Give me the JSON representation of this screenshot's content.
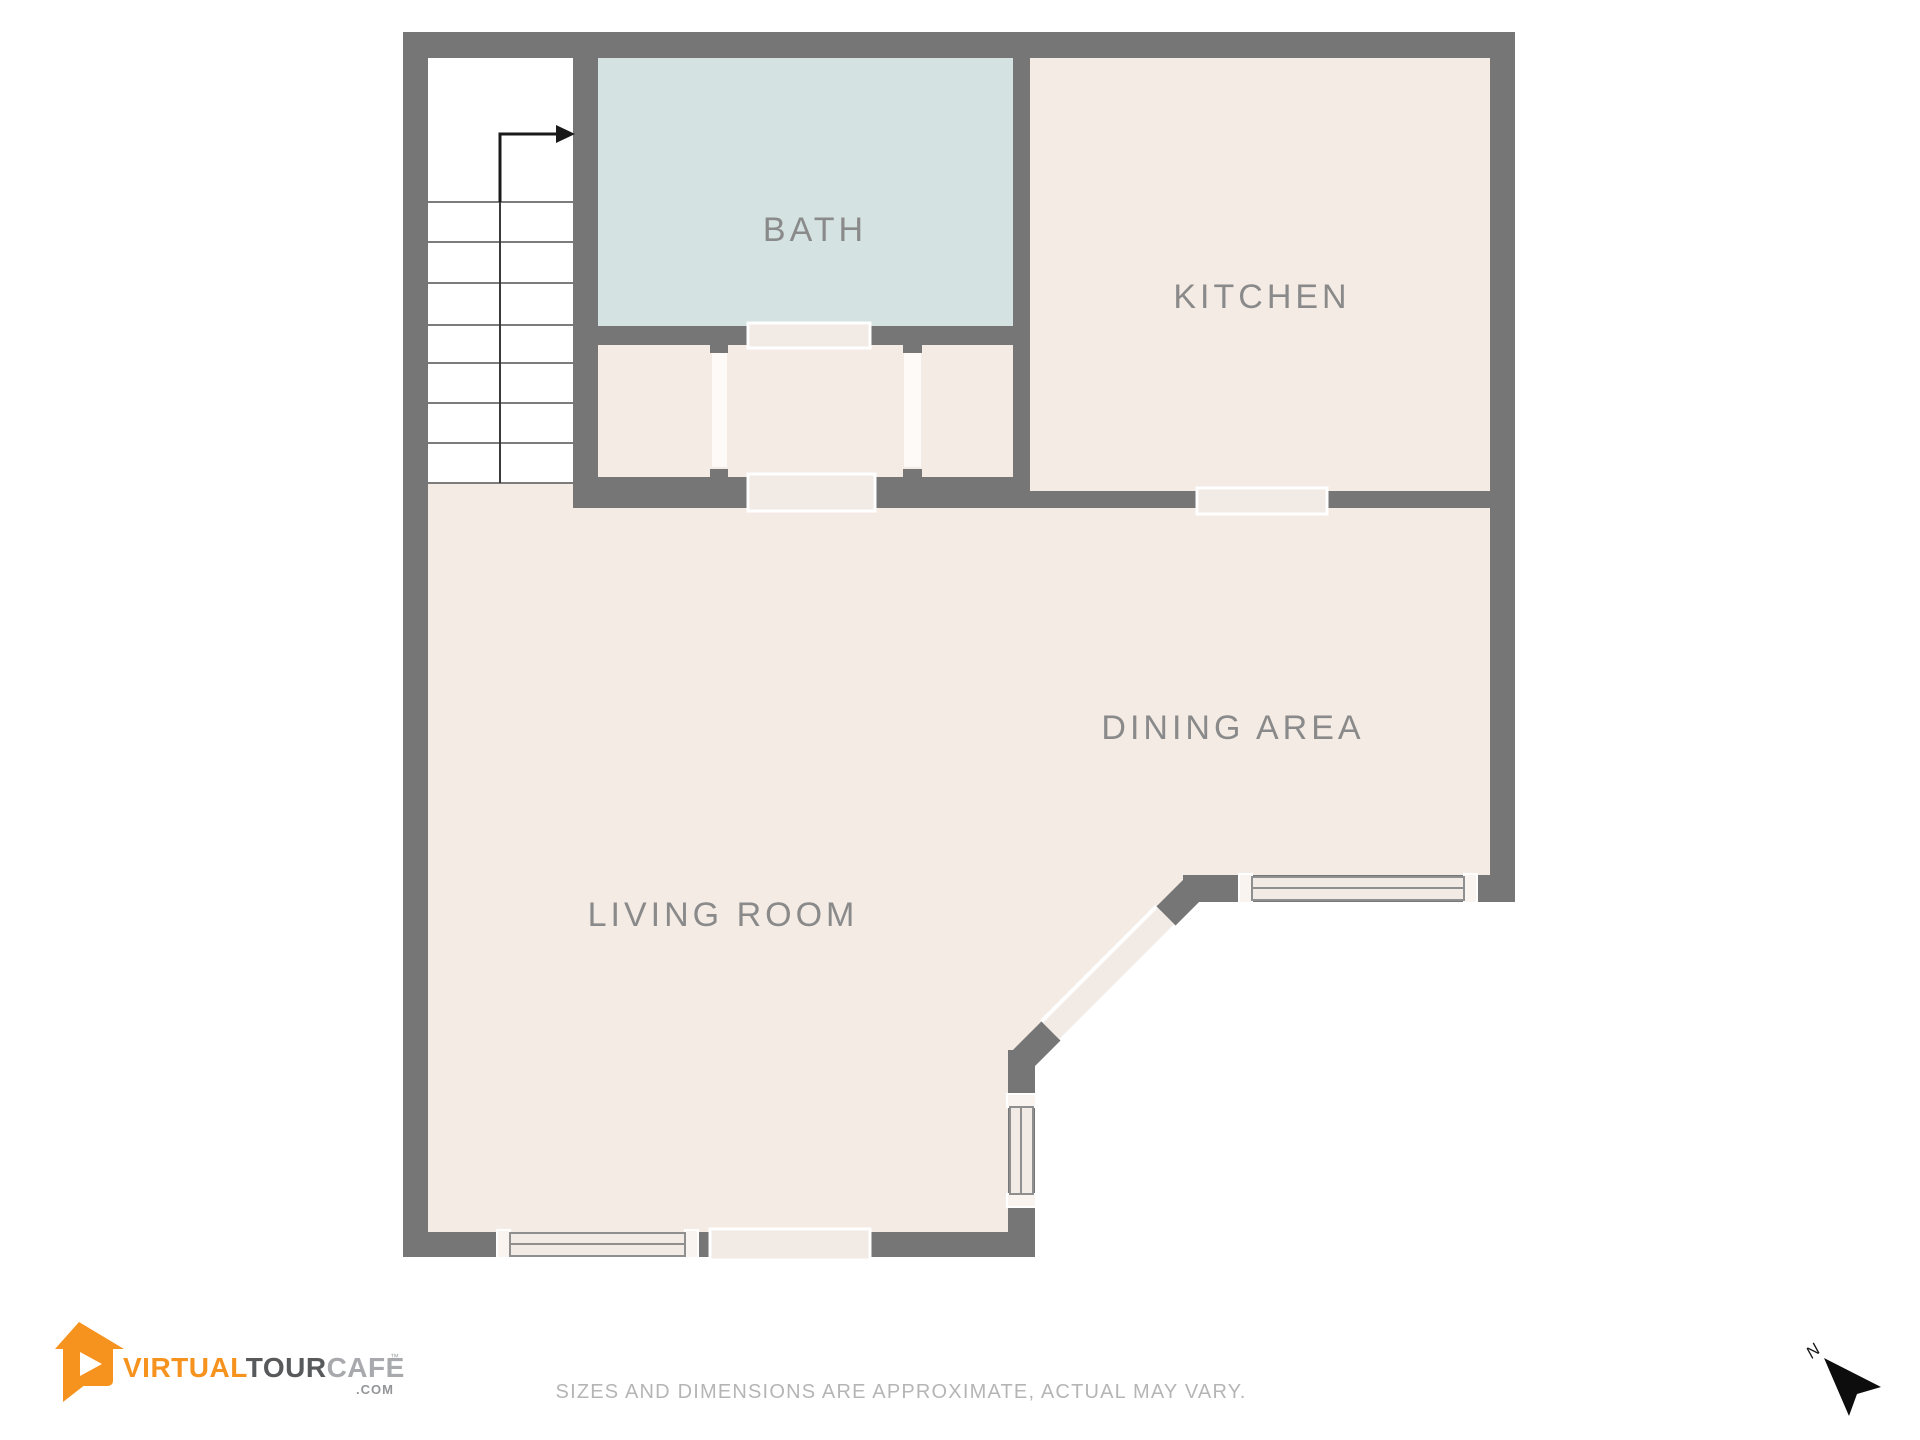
{
  "plan": {
    "rooms": {
      "bath": {
        "label": "BATH"
      },
      "kitchen": {
        "label": "KITCHEN"
      },
      "dining": {
        "label": "DINING AREA"
      },
      "living": {
        "label": "LIVING ROOM"
      }
    }
  },
  "compass": {
    "north_label": "N"
  },
  "footer": {
    "disclaimer": "SIZES AND DIMENSIONS ARE APPROXIMATE, ACTUAL MAY VARY."
  },
  "logo": {
    "word1": "VIRTUAL",
    "word2": "TOUR",
    "word3": "CAFE",
    "trademark": "™",
    "domain_suffix": ".COM"
  },
  "colors": {
    "wall": "#767676",
    "floor": "#f4ebe5",
    "bath_floor": "#d5e2e2",
    "stair_floor": "#ffffff",
    "label_text": "#8a8a8a",
    "disclaimer_text": "#b5b5b5",
    "logo_orange": "#f6921e",
    "logo_dark": "#58595b",
    "logo_light": "#a7a9ac",
    "compass": "#1a1a1a"
  }
}
